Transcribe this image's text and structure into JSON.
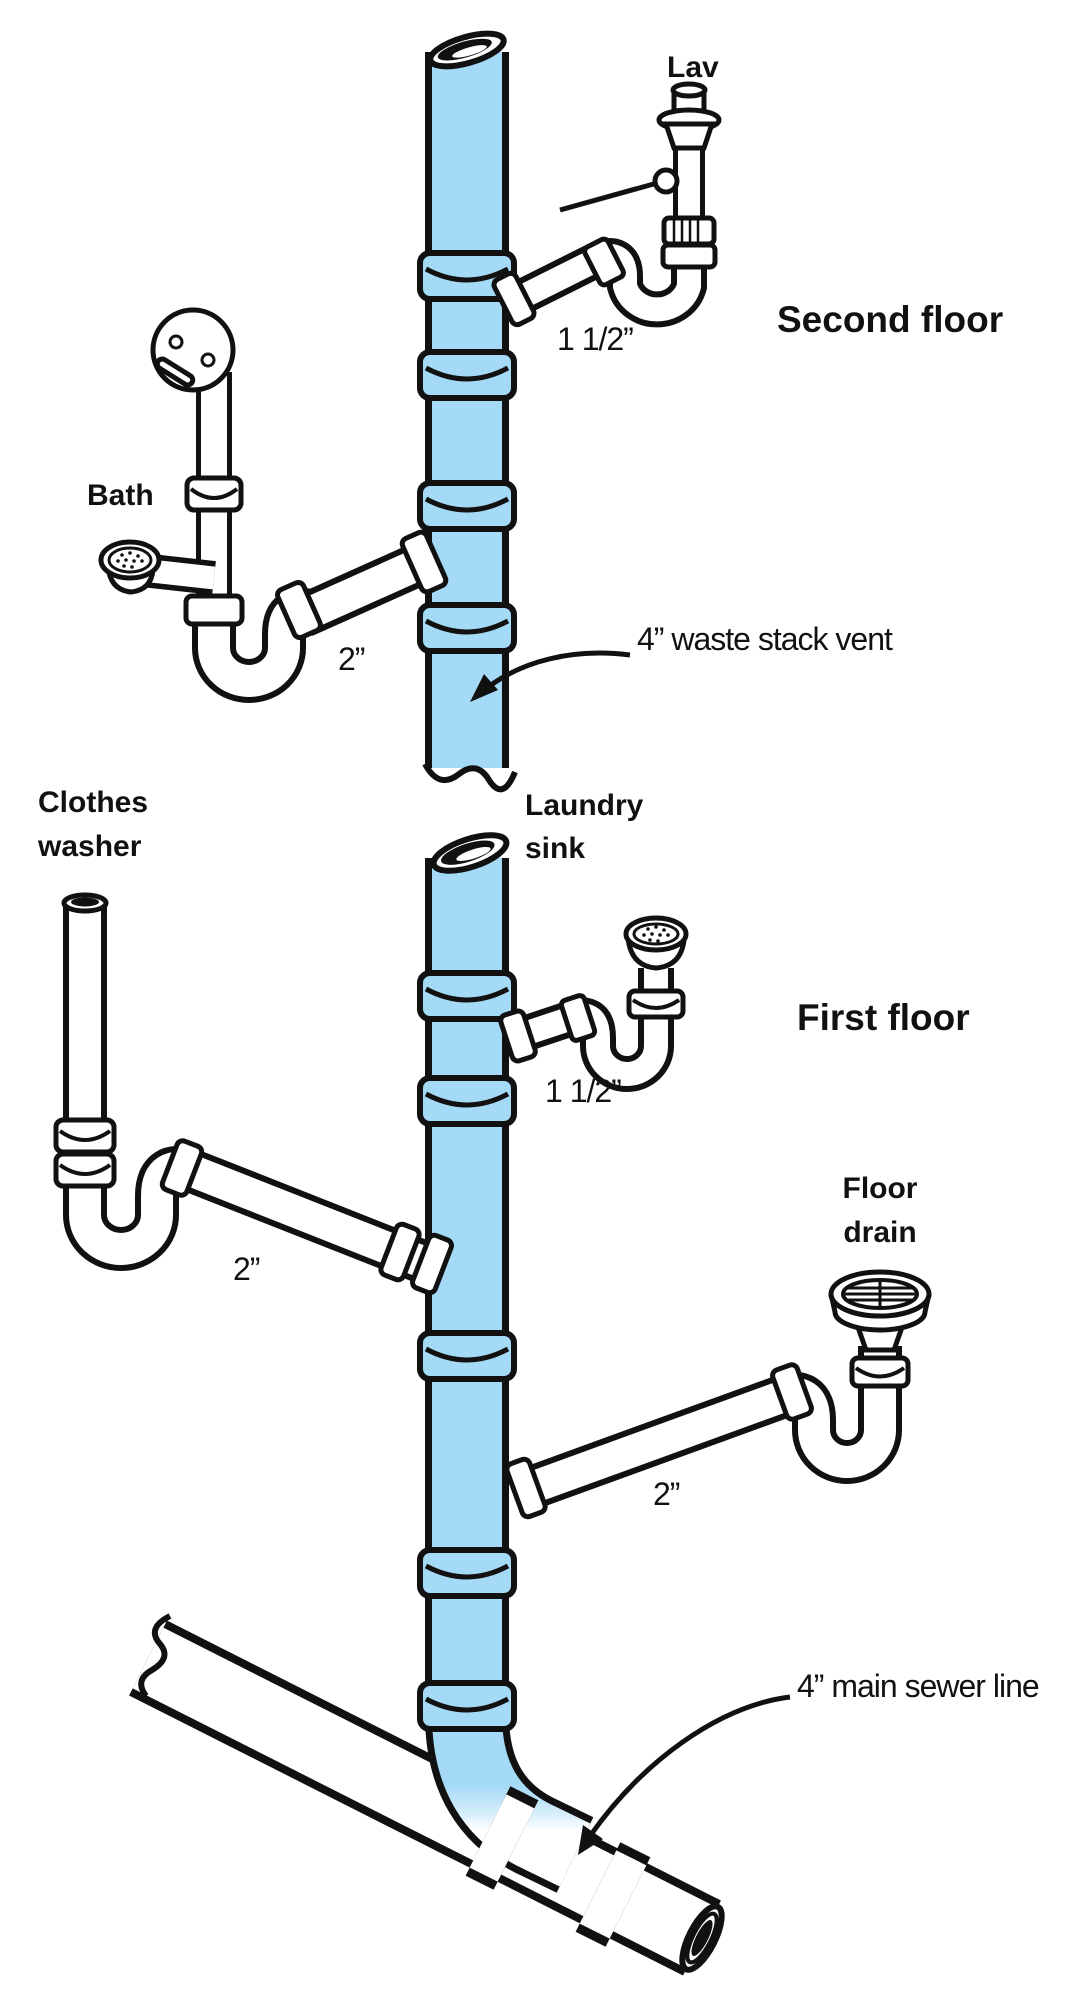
{
  "diagram": {
    "type": "plumbing-drain-waste-vent-isometric",
    "colors": {
      "stack_fill": "#a4daf5",
      "pipe_fill": "#ffffff",
      "line": "#111111",
      "background": "#ffffff"
    },
    "floors": {
      "second": "Second floor",
      "first": "First floor"
    },
    "fixtures": {
      "lav": "Lav",
      "bath": "Bath",
      "clothes_washer_line1": "Clothes",
      "clothes_washer_line2": "washer",
      "laundry_sink_line1": "Laundry",
      "laundry_sink_line2": "sink",
      "floor_drain_line1": "Floor",
      "floor_drain_line2": "drain"
    },
    "annotations": {
      "stack_vent": "4” waste stack vent",
      "main_sewer": "4” main sewer line"
    },
    "dimensions": {
      "lav_branch": "1 1/2”",
      "bath_branch": "2”",
      "laundry_branch": "1 1/2”",
      "washer_branch": "2”",
      "floor_drain_branch": "2”"
    }
  }
}
